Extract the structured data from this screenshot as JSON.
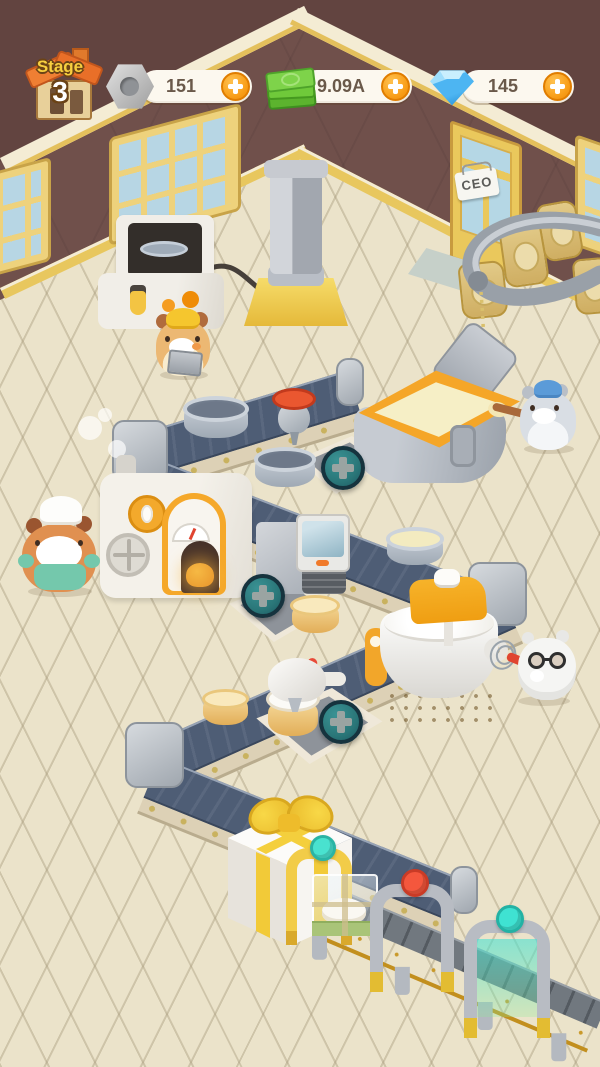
{
  "hud": {
    "stage": {
      "label": "Stage",
      "number": "3"
    },
    "currencies": [
      {
        "name": "screws",
        "icon": "nut-icon",
        "value": "151"
      },
      {
        "name": "cash",
        "icon": "cash-icon",
        "value": "9.09A"
      },
      {
        "name": "gems",
        "icon": "gem-icon",
        "value": "145"
      }
    ]
  },
  "scene": {
    "door_sign": "CEO",
    "objects": [
      "control-console",
      "hydraulic-press",
      "dough-funnel",
      "batter-vat",
      "bread-oven",
      "scanner-press",
      "stand-mixer",
      "cream-dispenser",
      "conveyor-zigzag",
      "gift-box",
      "packaging-line",
      "flour-sacks",
      "flour-tube"
    ],
    "characters": [
      "worker-hamster",
      "chef-hamster",
      "batter-hamster",
      "scientist-hamster"
    ],
    "add_machine_slots": 3
  },
  "colors": {
    "accent_orange": "#f5a62a",
    "button_teal": "#2e7f80",
    "belt": "#4e5d75",
    "wall": "#70504b",
    "floor": "#ebe3ca",
    "gold": "#f2cd3e",
    "gem_blue": "#4db8f5",
    "cash_green": "#6fc93a"
  }
}
